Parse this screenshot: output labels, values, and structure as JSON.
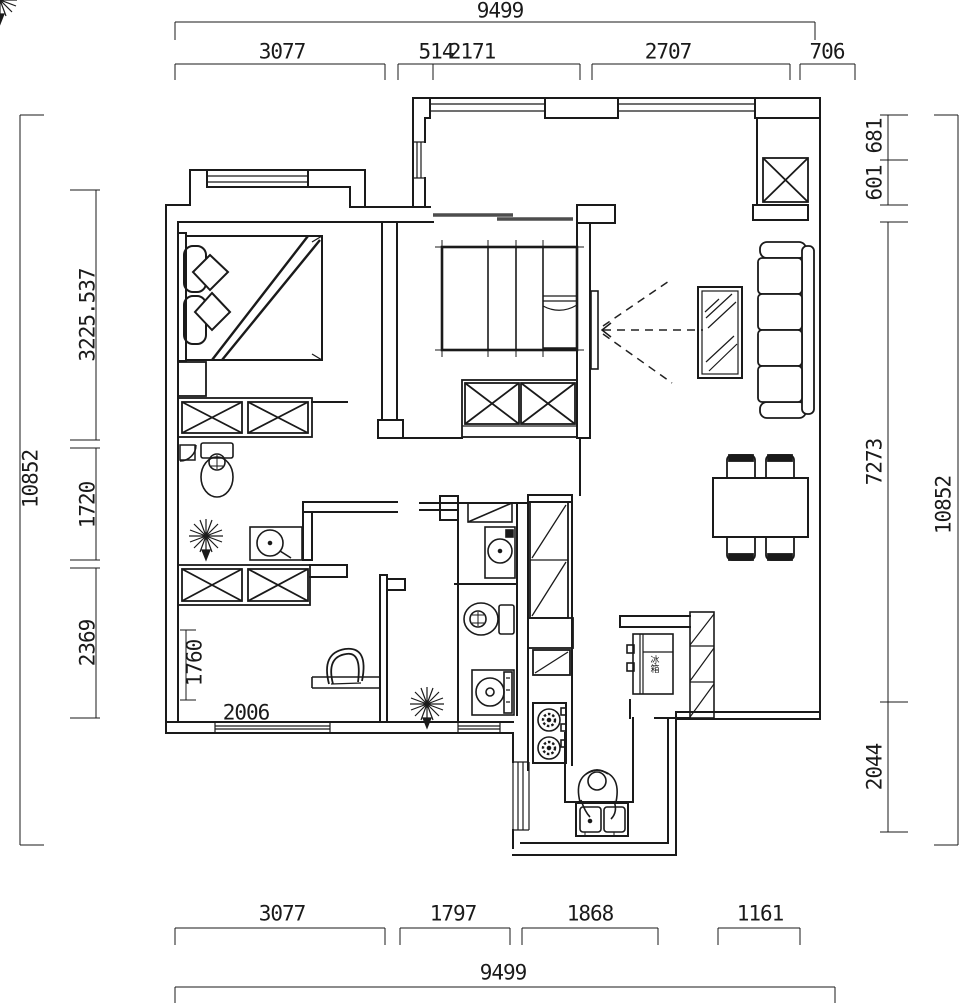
{
  "dimensions": {
    "top": {
      "outer": "9499",
      "segments": [
        "3077",
        "514",
        "2171",
        "2707",
        "706"
      ]
    },
    "bottom": {
      "outer": "9499",
      "segments": [
        "3077",
        "1797",
        "1868",
        "1161"
      ]
    },
    "left": {
      "outer": "10852",
      "segments": [
        "3225.537",
        "1720",
        "2369"
      ]
    },
    "right": {
      "outer": "10852",
      "segments": [
        "601",
        "681",
        "7273",
        "2044"
      ]
    },
    "interior": {
      "bedroom2_depth": "1760",
      "bedroom2_width": "2006"
    }
  },
  "labels": {
    "fridge": "冰箱"
  },
  "symbols": [
    "double-bed",
    "pillows",
    "nightstand",
    "wardrobe-x",
    "closet-shelves",
    "sofa",
    "tv-with-viewing-lines",
    "mirror-coffee-table",
    "dining-table-chairs",
    "toilet",
    "shower-corner",
    "washbasin",
    "washing-machine",
    "tall-cabinet",
    "stove-two-burners",
    "kitchen-sink",
    "person-washing",
    "fridge",
    "pantry-cabinet",
    "potted-plant",
    "desk-chair",
    "sliding-door",
    "window"
  ],
  "colors": {
    "ink": "#1a1a1a",
    "door_track": "#4d4d4d",
    "background": "#ffffff"
  }
}
